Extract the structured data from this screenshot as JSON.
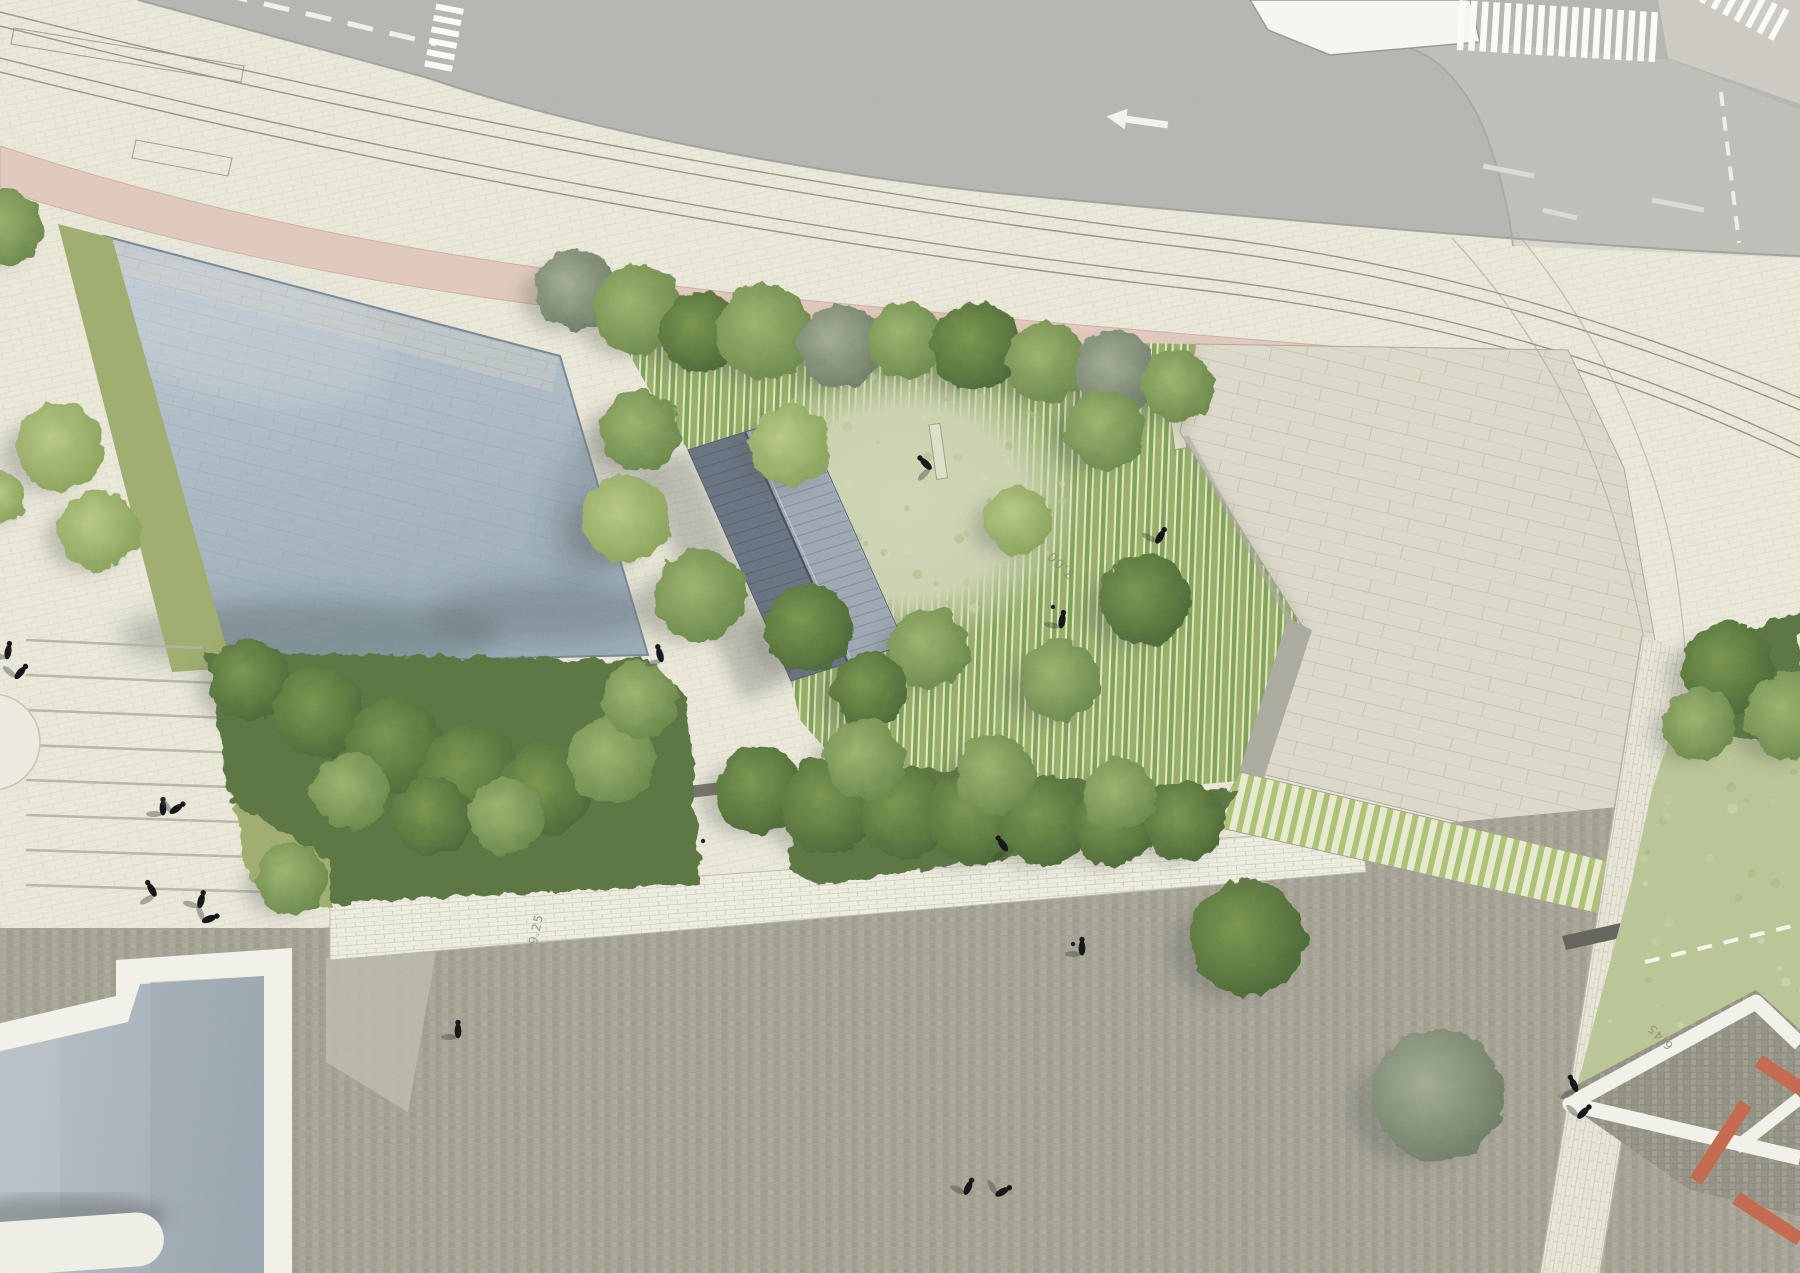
{
  "meta": {
    "type": "architectural-site-plan",
    "view": "aerial-render"
  },
  "palette": {
    "paving": "#e9e7d8",
    "paving_joint": "#d8d6c4",
    "road": "#b4b3af",
    "sidewalk": "#cbc9bf",
    "marking_white": "#f7f6f0",
    "track_line": "#8b897b",
    "bike_path_pink": "#e0c6ba",
    "water_joint": "#8fa0ac",
    "basin_edge": "#76848f",
    "grass_band": "#9dab6d",
    "clearing": "#cbd3ae",
    "shrub": "#5a7342",
    "lawn": "#b7c492",
    "roof_left": "#67727f",
    "roof_right": "#9ba5b0",
    "roof_ridge": "#47515c",
    "plaza": "#dbd8c8",
    "plaza_joint": "#b6b39f",
    "lower_plaza": "#a3a093",
    "cobble_dark": "#8d8a7e",
    "wall_light": "#bab7aa",
    "rim_white": "#f2f1e8",
    "pool": "#aab5bd",
    "terracotta": "#c3674e",
    "figure": "#17181a",
    "label_gray": "#8a8878",
    "shadow": "#3c4440"
  },
  "annotations": {
    "elevation_labels": [
      {
        "text": "7.00",
        "x": 1064,
        "y": 562,
        "rot": -135,
        "size": 13
      },
      {
        "text": "9.25",
        "x": 540,
        "y": 930,
        "rot": -78,
        "size": 12
      },
      {
        "text": "6.45",
        "x": 1663,
        "y": 1034,
        "rot": -135,
        "size": 12
      }
    ]
  },
  "map": {
    "trees": [
      [
        5,
        228,
        38,
        "mid"
      ],
      [
        60,
        447,
        44,
        "light"
      ],
      [
        99,
        530,
        40,
        "light"
      ],
      [
        0,
        497,
        26,
        "light"
      ],
      [
        575,
        290,
        40,
        "gray"
      ],
      [
        638,
        310,
        45,
        "mid"
      ],
      [
        700,
        332,
        40,
        "dark"
      ],
      [
        765,
        332,
        48,
        "mid"
      ],
      [
        840,
        346,
        42,
        "gray"
      ],
      [
        906,
        340,
        38,
        "mid"
      ],
      [
        976,
        346,
        45,
        "dark"
      ],
      [
        1046,
        362,
        40,
        "mid"
      ],
      [
        1116,
        372,
        42,
        "gray"
      ],
      [
        1178,
        386,
        36,
        "mid"
      ],
      [
        640,
        430,
        40,
        "mid"
      ],
      [
        626,
        520,
        44,
        "light"
      ],
      [
        790,
        445,
        40,
        "light"
      ],
      [
        700,
        595,
        46,
        "mid"
      ],
      [
        808,
        628,
        44,
        "dark"
      ],
      [
        930,
        648,
        40,
        "mid"
      ],
      [
        1018,
        520,
        34,
        "light"
      ],
      [
        1105,
        430,
        40,
        "mid"
      ],
      [
        1145,
        600,
        45,
        "dark"
      ],
      [
        1060,
        680,
        40,
        "mid"
      ],
      [
        870,
        690,
        38,
        "dark"
      ],
      [
        250,
        680,
        40,
        "dark"
      ],
      [
        320,
        712,
        46,
        "dark"
      ],
      [
        395,
        745,
        48,
        "dark"
      ],
      [
        470,
        775,
        50,
        "dark"
      ],
      [
        545,
        790,
        46,
        "dark"
      ],
      [
        612,
        760,
        44,
        "mid"
      ],
      [
        640,
        700,
        38,
        "mid"
      ],
      [
        350,
        792,
        38,
        "mid"
      ],
      [
        432,
        816,
        40,
        "dark"
      ],
      [
        506,
        816,
        38,
        "mid"
      ],
      [
        760,
        790,
        44,
        "dark"
      ],
      [
        830,
        806,
        48,
        "dark"
      ],
      [
        905,
        812,
        46,
        "dark"
      ],
      [
        975,
        818,
        48,
        "dark"
      ],
      [
        1045,
        822,
        44,
        "dark"
      ],
      [
        1115,
        825,
        42,
        "dark"
      ],
      [
        1185,
        822,
        40,
        "dark"
      ],
      [
        865,
        760,
        40,
        "mid"
      ],
      [
        995,
        775,
        40,
        "mid"
      ],
      [
        1120,
        795,
        36,
        "mid"
      ],
      [
        292,
        878,
        36,
        "mid"
      ],
      [
        1728,
        668,
        46,
        "dark"
      ],
      [
        1790,
        716,
        44,
        "mid"
      ],
      [
        1700,
        724,
        36,
        "mid"
      ],
      [
        1247,
        938,
        58,
        "dark"
      ],
      [
        1438,
        1095,
        66,
        "gray"
      ]
    ],
    "figures": [
      [
        8,
        652,
        10
      ],
      [
        20,
        673,
        40
      ],
      [
        163,
        808,
        0
      ],
      [
        176,
        809,
        55
      ],
      [
        152,
        890,
        -30
      ],
      [
        201,
        901,
        15
      ],
      [
        209,
        919,
        70
      ],
      [
        458,
        1031,
        0
      ],
      [
        1003,
        845,
        -35
      ],
      [
        968,
        1188,
        25
      ],
      [
        1002,
        1192,
        60
      ],
      [
        1082,
        948,
        0
      ],
      [
        660,
        655,
        -15
      ],
      [
        926,
        464,
        -45
      ],
      [
        1160,
        537,
        30
      ],
      [
        1062,
        621,
        10
      ],
      [
        1574,
        1085,
        -25
      ],
      [
        1583,
        1113,
        45
      ]
    ],
    "dots": [
      [
        703,
        841
      ],
      [
        1053,
        607
      ],
      [
        1073,
        944
      ]
    ],
    "garden_benches": [
      [
        929,
        425,
        11,
        55,
        -8
      ],
      [
        1168,
        400,
        12,
        50,
        -8
      ],
      [
        836,
        587,
        10,
        46,
        -8
      ]
    ],
    "terracotta_benches": [
      {
        "x": 1762,
        "y": 1055,
        "w": 64,
        "h": 14,
        "rot": 33
      },
      {
        "x": 1740,
        "y": 1100,
        "w": 14,
        "h": 92,
        "rot": 33
      },
      {
        "x": 1740,
        "y": 1192,
        "w": 76,
        "h": 14,
        "rot": 33
      }
    ],
    "building": {
      "seams": 23
    },
    "stairs_steps": 8,
    "crosswalks": {
      "main_stripes": 18,
      "corner_stripes": 7,
      "left_stripes": 6
    },
    "clearing_dots": {
      "count": 80,
      "seed": 3
    },
    "lawn_dots": {
      "count": 60,
      "seed": 9
    }
  }
}
